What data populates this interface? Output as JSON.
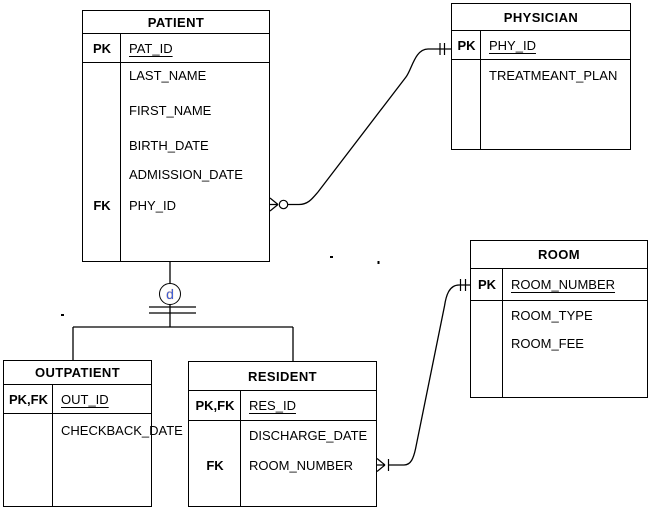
{
  "tables": {
    "patient": {
      "title": "PATIENT",
      "pk": {
        "key": "PK",
        "attr": "PAT_ID"
      },
      "rows": [
        {
          "key": "",
          "attr": "LAST_NAME"
        },
        {
          "key": "",
          "attr": "FIRST_NAME"
        },
        {
          "key": "",
          "attr": "BIRTH_DATE"
        },
        {
          "key": "",
          "attr": "ADMISSION_DATE"
        },
        {
          "key": "FK",
          "attr": "PHY_ID"
        }
      ]
    },
    "physician": {
      "title": "PHYSICIAN",
      "pk": {
        "key": "PK",
        "attr": "PHY_ID"
      },
      "rows": [
        {
          "key": "",
          "attr": "TREATMEANT_PLAN"
        }
      ]
    },
    "room": {
      "title": "ROOM",
      "pk": {
        "key": "PK",
        "attr": "ROOM_NUMBER"
      },
      "rows": [
        {
          "key": "",
          "attr": "ROOM_TYPE"
        },
        {
          "key": "",
          "attr": "ROOM_FEE"
        }
      ]
    },
    "outpatient": {
      "title": "OUTPATIENT",
      "pk": {
        "key": "PK,FK",
        "attr": "OUT_ID"
      },
      "rows": [
        {
          "key": "",
          "attr": "CHECKBACK_DATE"
        }
      ]
    },
    "resident": {
      "title": "RESIDENT",
      "pk": {
        "key": "PK,FK",
        "attr": "RES_ID"
      },
      "rows": [
        {
          "key": "",
          "attr": "DISCHARGE_DATE"
        },
        {
          "key": "FK",
          "attr": "ROOM_NUMBER"
        }
      ]
    }
  },
  "hierarchy": {
    "disjoint_label": "d"
  },
  "colors": {
    "line": "#000000",
    "background": "#ffffff",
    "disjoint_letter": "#3c5fd7",
    "disjoint_halo": "#f5a25d"
  }
}
